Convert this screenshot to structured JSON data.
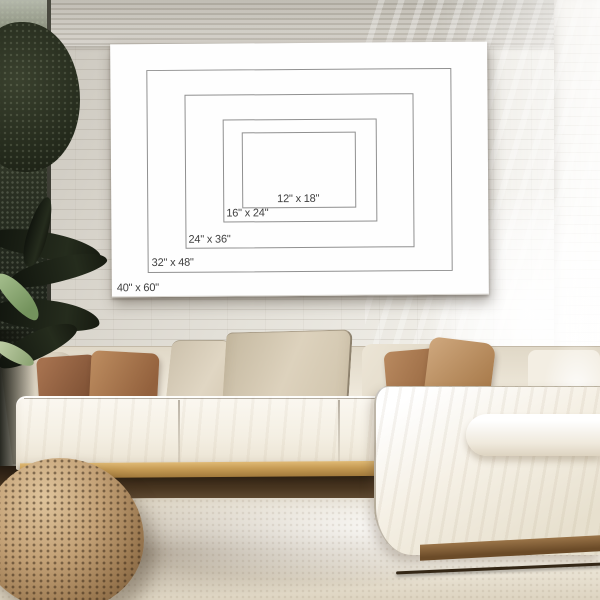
{
  "poster": {
    "title": "Canvas print size comparison chart",
    "sizes": [
      {
        "id": "12x18",
        "label": "12\" x 18\"",
        "width_in": 12,
        "height_in": 18
      },
      {
        "id": "16x24",
        "label": "16\" x 24\"",
        "width_in": 16,
        "height_in": 24
      },
      {
        "id": "24x36",
        "label": "24\" x 36\"",
        "width_in": 24,
        "height_in": 36
      },
      {
        "id": "32x48",
        "label": "32\" x 48\"",
        "width_in": 32,
        "height_in": 48
      },
      {
        "id": "40x60",
        "label": "40\" x 60\"",
        "width_in": 40,
        "height_in": 60
      }
    ],
    "colors": {
      "poster_background": "#fefefe",
      "rect_outline": "#909090",
      "label_text": "#3f3f3f"
    }
  }
}
